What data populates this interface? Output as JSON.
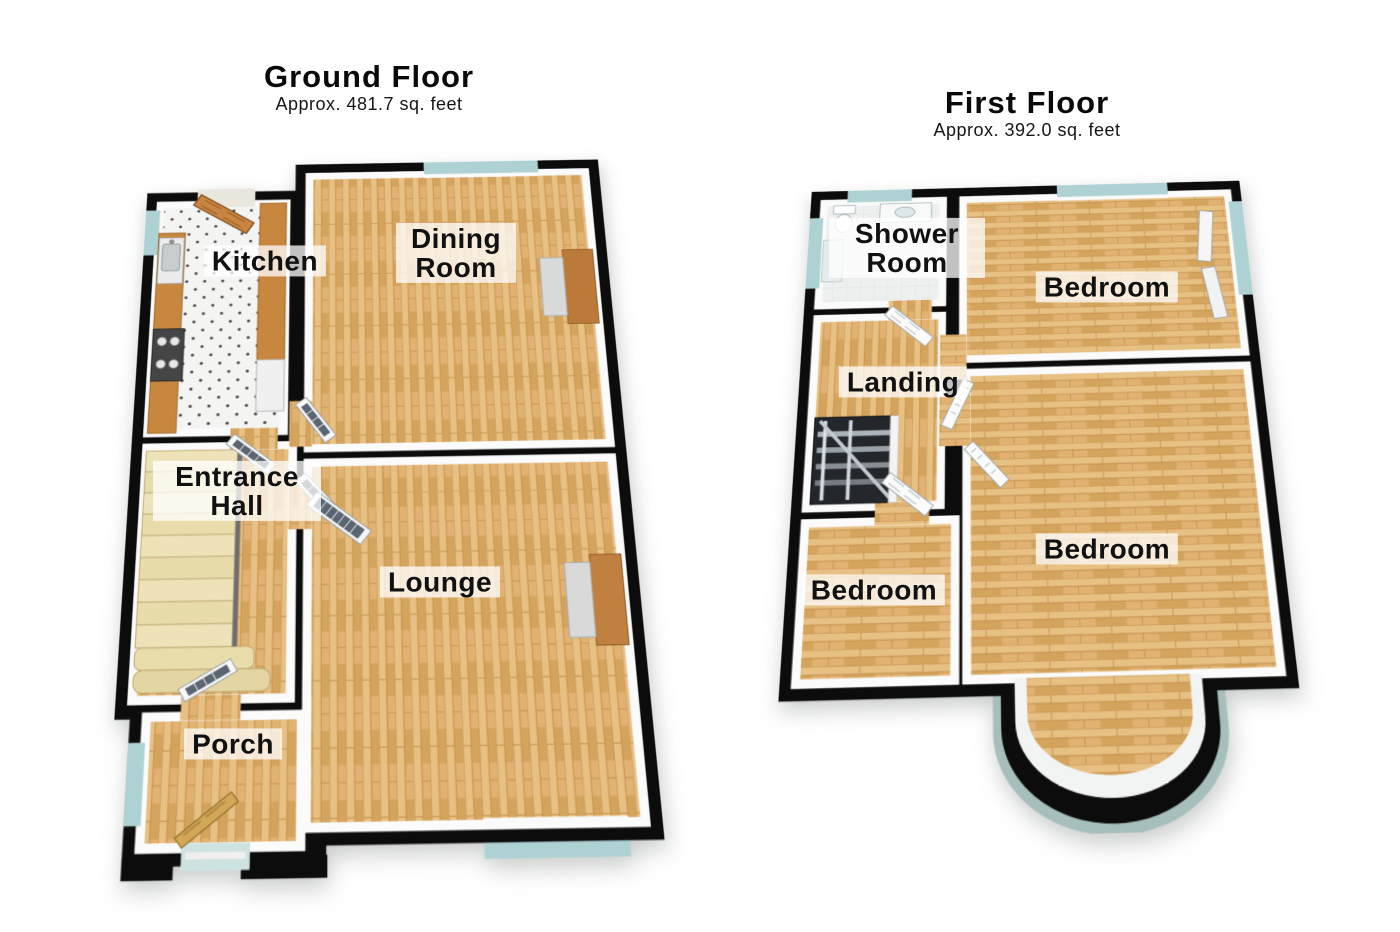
{
  "page": {
    "background": "#ffffff"
  },
  "ground_floor": {
    "title": "Ground Floor",
    "subtitle": "Approx. 481.7 sq. feet",
    "rooms": [
      {
        "name": "Kitchen"
      },
      {
        "name": "Dining Room"
      },
      {
        "name": "Entrance Hall"
      },
      {
        "name": "Lounge"
      },
      {
        "name": "Porch"
      }
    ]
  },
  "first_floor": {
    "title": "First Floor",
    "subtitle": "Approx. 392.0 sq. feet",
    "rooms": [
      {
        "name": "Shower Room"
      },
      {
        "name": "Bedroom"
      },
      {
        "name": "Landing"
      },
      {
        "name": "Bedroom"
      },
      {
        "name": "Bedroom"
      }
    ]
  },
  "style": {
    "wall_color": "#0c0c0c",
    "wood_floor_color": "#dcae6c",
    "window_glass_color": "#aed2d4",
    "stair_color": "#eadfb2",
    "kitchen_counter_color": "#c8873f",
    "label_background": "rgba(255,255,255,0.75)",
    "label_text_color": "#111111"
  }
}
